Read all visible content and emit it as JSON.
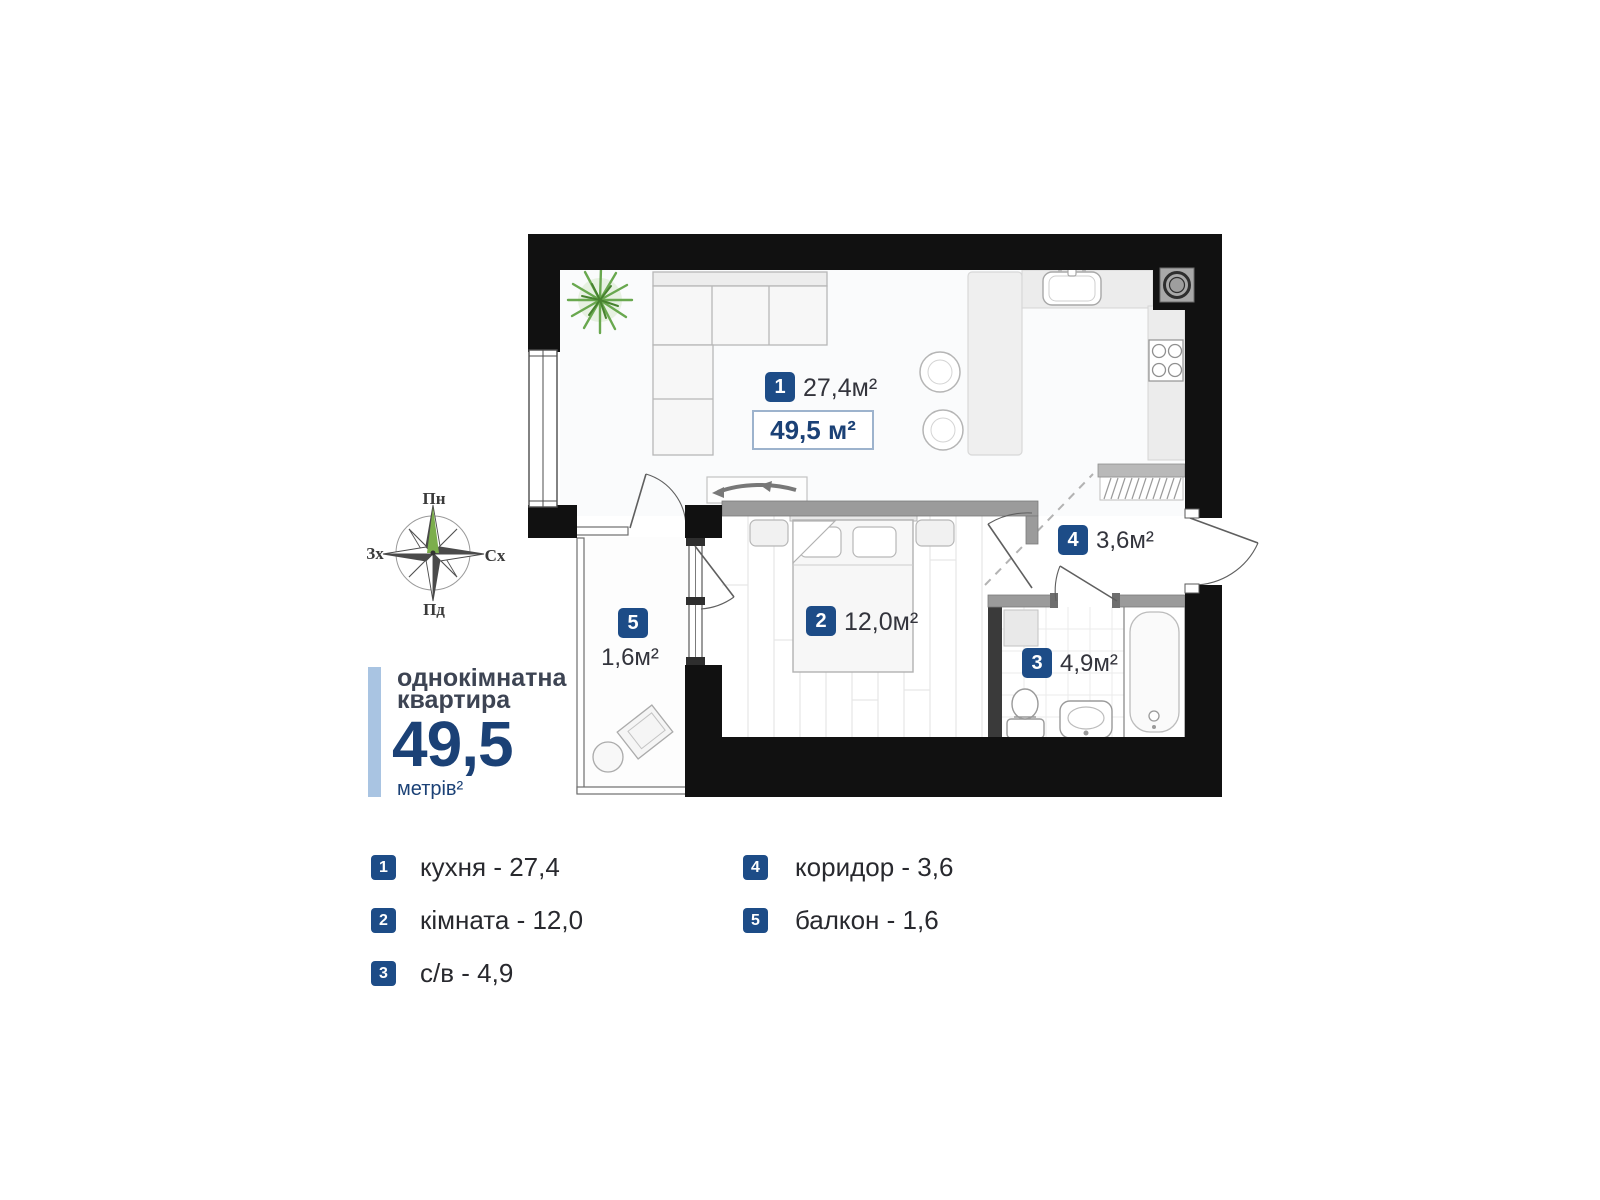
{
  "plan": {
    "total_area_label": "49,5 м²",
    "rooms": [
      {
        "num": "1",
        "area": "27,4м²"
      },
      {
        "num": "2",
        "area": "12,0м²"
      },
      {
        "num": "3",
        "area": "4,9м²"
      },
      {
        "num": "4",
        "area": "3,6м²"
      },
      {
        "num": "5",
        "area": "1,6м²"
      }
    ]
  },
  "compass": {
    "north": "Пн",
    "south": "Пд",
    "west": "Зх",
    "east": "Сх"
  },
  "summary": {
    "title_line1": "однокімнатна",
    "title_line2": "квартира",
    "area_value": "49,5",
    "area_unit": "метрів²"
  },
  "legend": [
    {
      "num": "1",
      "label": "кухня - 27,4"
    },
    {
      "num": "2",
      "label": "кімната - 12,0"
    },
    {
      "num": "3",
      "label": "с/в - 4,9"
    },
    {
      "num": "4",
      "label": "коридор - 3,6"
    },
    {
      "num": "5",
      "label": "балкон - 1,6"
    }
  ],
  "colors": {
    "badge_navy": "#1d4c87",
    "accent_navy": "#1b4176",
    "light_blue_bar": "#a9c4e2",
    "wall_black": "#111111",
    "partition_gray": "#9b9b9b",
    "plant_green": "#69a84f"
  }
}
